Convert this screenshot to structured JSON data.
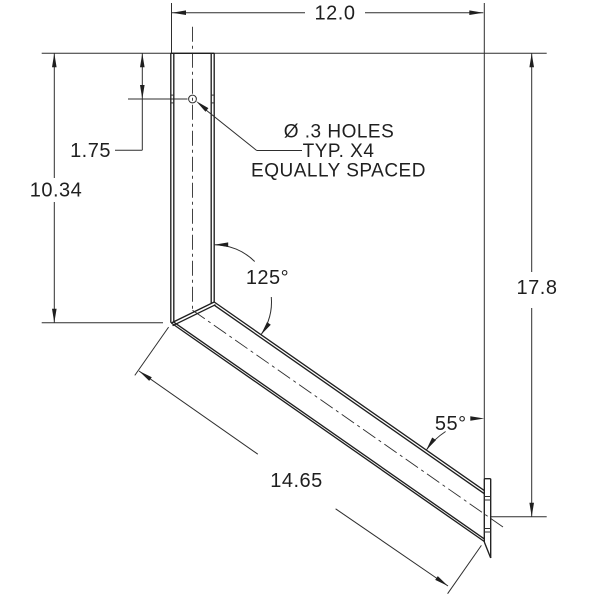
{
  "drawing": {
    "dimensions": {
      "overall_width": "12.0",
      "hole_offset": "1.75",
      "upright_height": "10.34",
      "bend_angle": "125°",
      "overall_height": "17.8",
      "end_angle": "55°",
      "arm_length": "14.65"
    },
    "note": {
      "line1": "Ø .3 HOLES",
      "line2": "TYP. X4",
      "line3": "EQUALLY SPACED"
    },
    "colors": {
      "line": "#1f1f1f",
      "background": "#ffffff"
    }
  }
}
